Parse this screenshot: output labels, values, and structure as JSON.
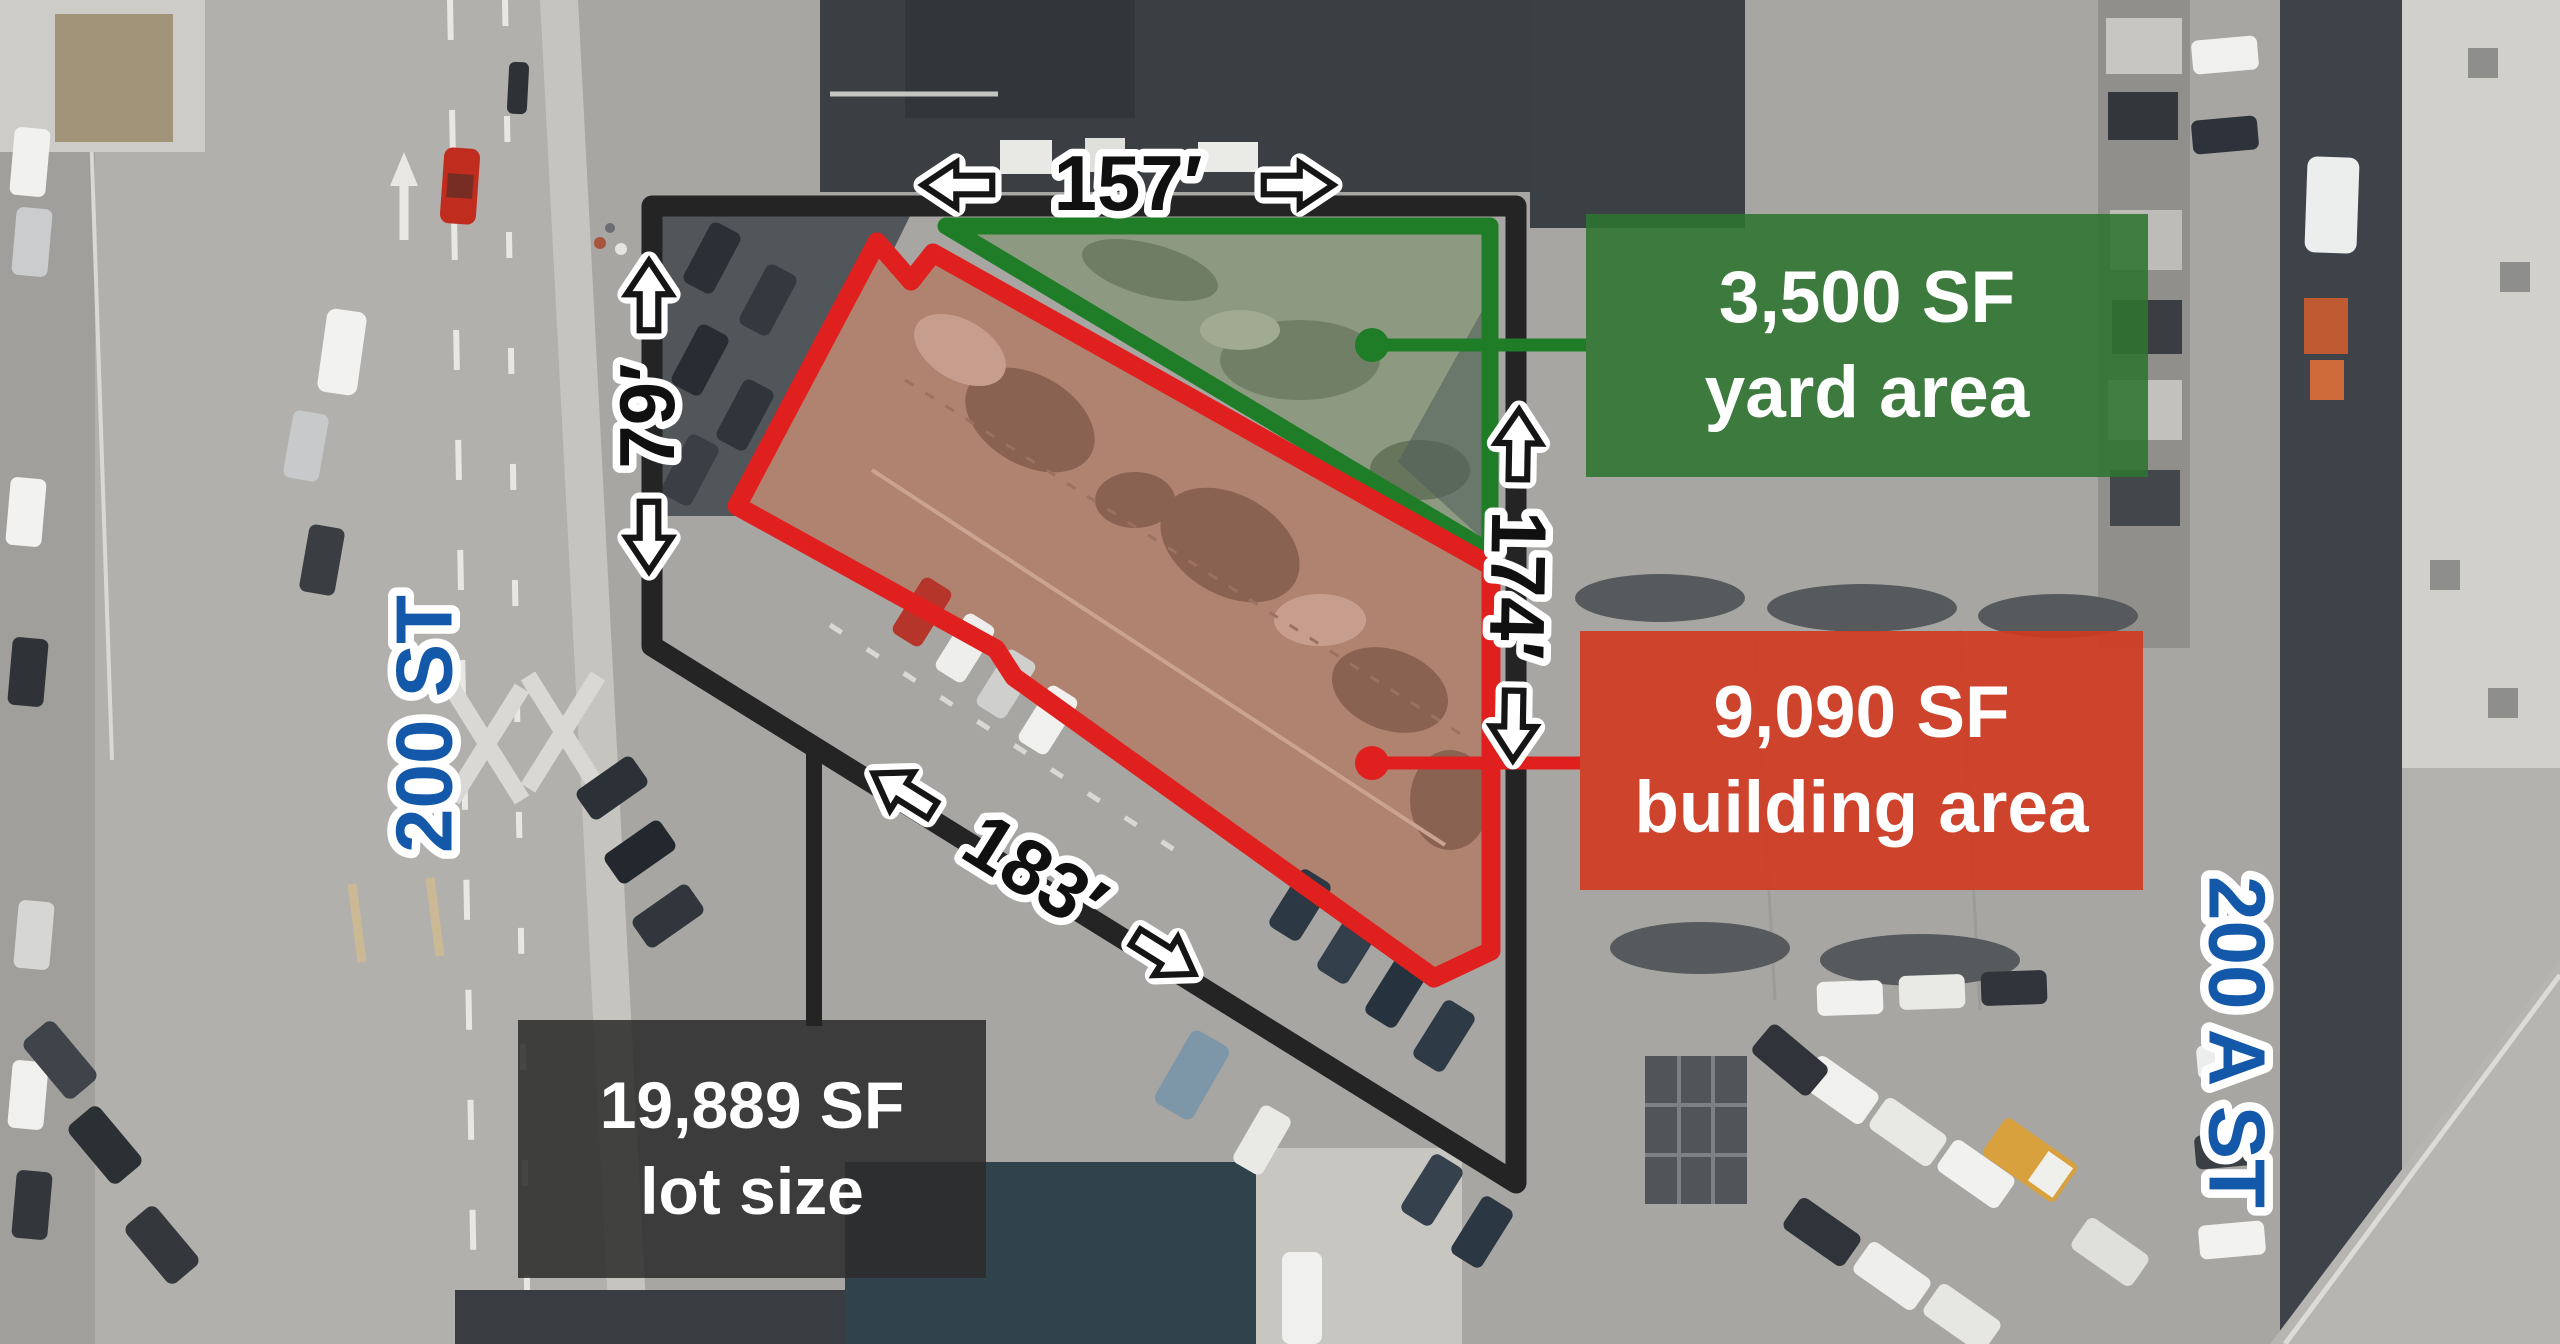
{
  "callouts": {
    "yard": {
      "line1": "3,500 SF",
      "line2": "yard area"
    },
    "building": {
      "line1": "9,090 SF",
      "line2": "building area"
    },
    "lot": {
      "line1": "19,889 SF",
      "line2": "lot size"
    }
  },
  "dimensions": {
    "top": "157′",
    "left": "79′",
    "right": "174′",
    "bottom": "183′"
  },
  "streets": {
    "left": "200 ST",
    "right": "200 A ST"
  },
  "arrows": {
    "left": "arrow-left",
    "right": "arrow-right",
    "up": "arrow-up",
    "down": "arrow-down"
  },
  "colors": {
    "yard_accent": "#1f7d28",
    "yard_box": "rgba(45,116,48,0.88)",
    "building_accent": "#e0201f",
    "building_box": "rgba(209,56,31,0.9)",
    "lot_accent": "#242424",
    "lot_box": "rgba(43,43,43,0.86)",
    "street_text": "#1459a9",
    "dimension_text": "#101010"
  }
}
